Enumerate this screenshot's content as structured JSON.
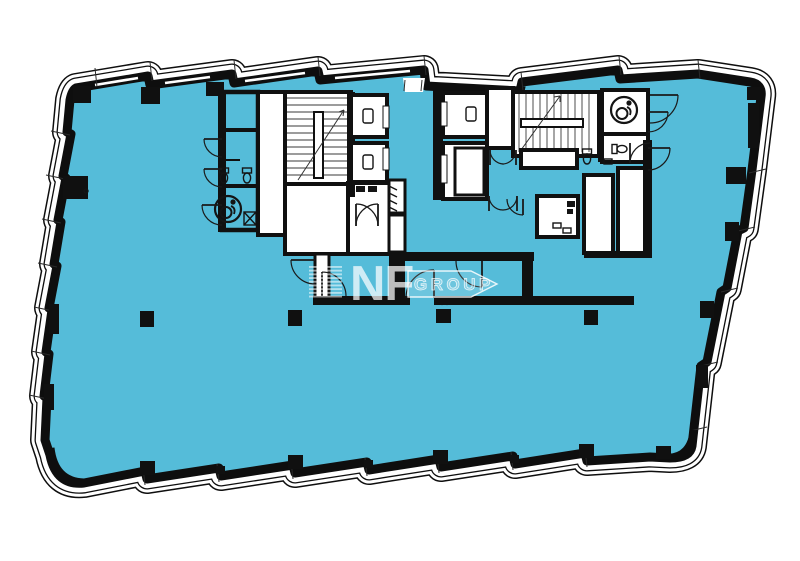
{
  "watermark": {
    "brand": "NF",
    "suffix": "GROUP"
  },
  "palette": {
    "floor_fill": "#55bcd9",
    "wall_ink": "#101010",
    "background": "#ffffff",
    "watermark_ink": "rgba(255,255,255,0.72)",
    "watermark_outline_fill": "rgba(255,255,255,0.25)"
  },
  "icons": {
    "wheelchair": "accessible-wc-icon",
    "toilet": "toilet-icon",
    "elevator_car": "elevator-car-icon",
    "stair_run": "stair-run-icon",
    "column": "structural-column",
    "door": "door-swing-arc"
  }
}
